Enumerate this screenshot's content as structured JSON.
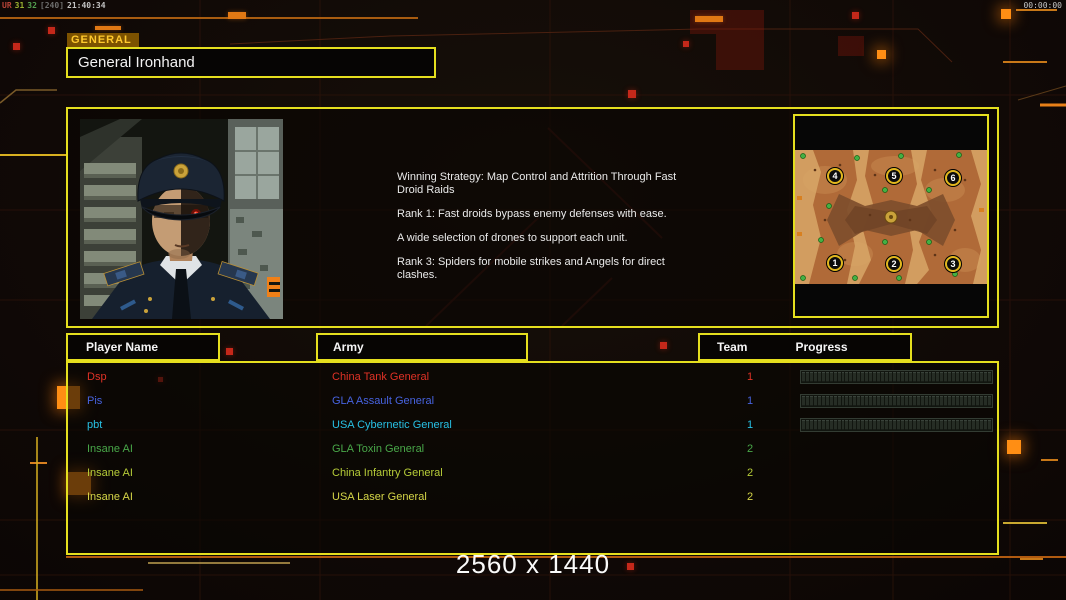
{
  "osd": {
    "segments": [
      {
        "text": "UR",
        "color": "#b84438"
      },
      {
        "text": "31",
        "color": "#9ab030"
      },
      {
        "text": "32",
        "color": "#54a050"
      },
      {
        "text": "[240]",
        "color": "#6e6e6e"
      },
      {
        "text": "21:40:34",
        "color": "#c4c4c4"
      }
    ],
    "session_timer": "00:00:00"
  },
  "general_panel": {
    "tab_label": "GENERAL",
    "name": "General Ironhand"
  },
  "briefing": {
    "line1": "Winning Strategy: Map Control and Attrition Through Fast Droid Raids",
    "line2": "Rank 1: Fast droids bypass enemy defenses with ease.",
    "line3": "A wide selection of drones to support each unit.",
    "line4": "Rank 3: Spiders for mobile strikes and Angels for direct clashes."
  },
  "map_preview": {
    "start_positions": [
      "1",
      "2",
      "3",
      "4",
      "5",
      "6"
    ]
  },
  "lobby_table": {
    "header_player": "Player Name",
    "header_army": "Army",
    "header_team": "Team",
    "header_progress": "Progress",
    "rows": [
      {
        "player": "Dsp",
        "army": "China Tank General",
        "team": "1",
        "color": "#e03226",
        "has_progress": true
      },
      {
        "player": "Pis",
        "army": "GLA Assault General",
        "team": "1",
        "color": "#4763e0",
        "has_progress": true
      },
      {
        "player": "pbt",
        "army": "USA Cybernetic General",
        "team": "1",
        "color": "#28c0e4",
        "has_progress": true
      },
      {
        "player": "Insane AI",
        "army": "GLA Toxin General",
        "team": "2",
        "color": "#49a849",
        "has_progress": false
      },
      {
        "player": "Insane AI",
        "army": "China Infantry General",
        "team": "2",
        "color": "#b6cc38",
        "has_progress": false
      },
      {
        "player": "Insane AI",
        "army": "USA Laser General",
        "team": "2",
        "color": "#d6d648",
        "has_progress": false
      }
    ]
  },
  "footer": {
    "resolution": "2560 x 1440"
  },
  "colors": {
    "frame_yellow": "#e5df1e",
    "accent_orange": "#ff8e14",
    "tab_bg": "#7c5200",
    "tab_text": "#ffc92e"
  }
}
